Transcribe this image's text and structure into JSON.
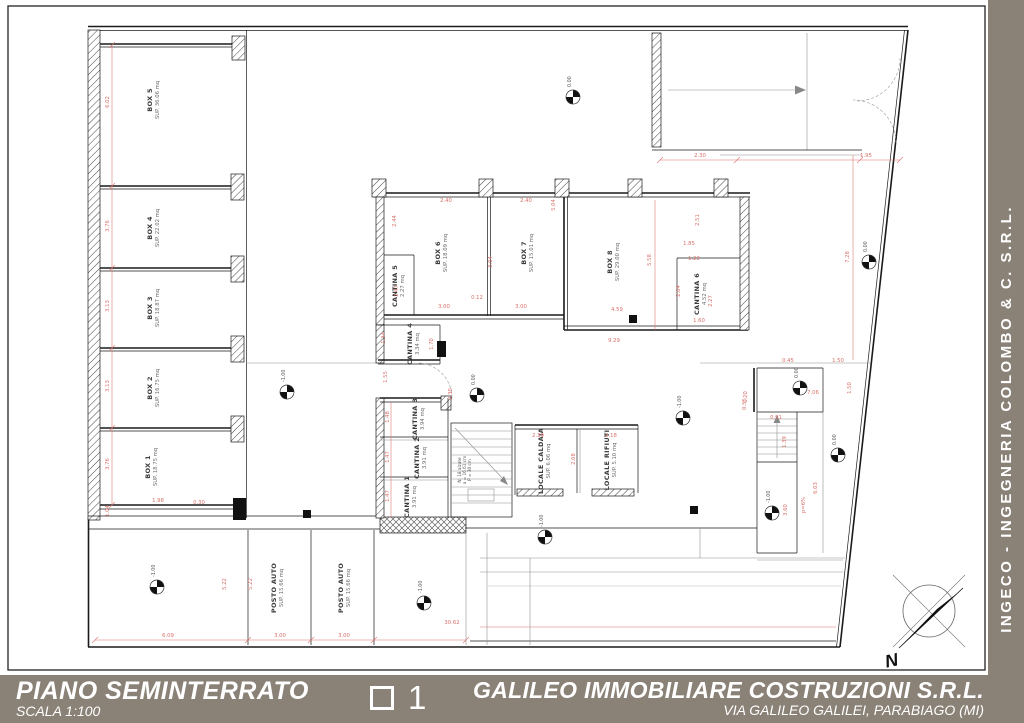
{
  "colors": {
    "band": "#8a8177",
    "dimred": "#d9706a",
    "wall": "#1a1a1a"
  },
  "titlebar": {
    "plan_title": "PIANO SEMINTERRATO",
    "scale": "SCALA 1:100",
    "sheet_number": "1",
    "company": "GALILEO IMMOBILIARE COSTRUZIONI S.R.L.",
    "address": "VIA GALILEO GALILEI, PARABIAGO (MI)"
  },
  "sidebar": {
    "text": "INGECO - INGEGNERIA COLOMBO & C. S.R.L."
  },
  "compass": {
    "label": "N"
  },
  "plan": {
    "rooms": [
      {
        "label": "BOX 5",
        "area": "SUP. 36.06 mq",
        "x": 152,
        "y": 100
      },
      {
        "label": "BOX 4",
        "area": "SUP. 22.02 mq",
        "x": 152,
        "y": 228
      },
      {
        "label": "BOX 3",
        "area": "SUP. 18.87 mq",
        "x": 152,
        "y": 308
      },
      {
        "label": "BOX 2",
        "area": "SUP. 16.75 mq",
        "x": 152,
        "y": 388
      },
      {
        "label": "BOX 1",
        "area": "SUP. 18.75 mq",
        "x": 150,
        "y": 467
      },
      {
        "label": "BOX 6",
        "area": "SUP. 18.09 mq",
        "x": 440,
        "y": 253
      },
      {
        "label": "BOX 7",
        "area": "SUP. 15.01 mq",
        "x": 526,
        "y": 253
      },
      {
        "label": "BOX 8",
        "area": "SUP. 29.00 mq",
        "x": 612,
        "y": 262
      },
      {
        "label": "CANTINA 5",
        "area": "2.27 mq",
        "x": 397,
        "y": 286
      },
      {
        "label": "CANTINA 4",
        "area": "3.34 mq",
        "x": 412,
        "y": 344
      },
      {
        "label": "CANTINA 3",
        "area": "3.94 mq",
        "x": 417,
        "y": 419
      },
      {
        "label": "CANTINA 2",
        "area": "3.91 mq",
        "x": 419,
        "y": 458
      },
      {
        "label": "CANTINA 1",
        "area": "3.91 mq",
        "x": 409,
        "y": 497
      },
      {
        "label": "CANTINA 6",
        "area": "4.52 mq",
        "x": 699,
        "y": 294
      },
      {
        "label": "LOCALE CALDAIA",
        "area": "SUP. 6.06 mq",
        "x": 543,
        "y": 461
      },
      {
        "label": "LOCALE RIFIUTI",
        "area": "SUP. 5.10 mq",
        "x": 609,
        "y": 460
      },
      {
        "label": "POSTO AUTO",
        "area": "SUP. 15.66 mq",
        "x": 276,
        "y": 588
      },
      {
        "label": "POSTO AUTO",
        "area": "SUP. 15.66 mq",
        "x": 343,
        "y": 588
      }
    ],
    "stair_note": {
      "lines": [
        "N. 18 alzate",
        "a = 16.61 cm",
        "P = 30 cm"
      ],
      "x": 461,
      "y": 470
    },
    "dimensions": [
      {
        "t": "6.02",
        "x": 109,
        "y": 102,
        "o": "v"
      },
      {
        "t": "3.76",
        "x": 109,
        "y": 226,
        "o": "v"
      },
      {
        "t": "3.13",
        "x": 109,
        "y": 306,
        "o": "v"
      },
      {
        "t": "3.13",
        "x": 109,
        "y": 386,
        "o": "v"
      },
      {
        "t": "3.76",
        "x": 109,
        "y": 464,
        "o": "v"
      },
      {
        "t": "1.04",
        "x": 109,
        "y": 511,
        "o": "v"
      },
      {
        "t": "1.98",
        "x": 158,
        "y": 502,
        "o": "h"
      },
      {
        "t": "0.30",
        "x": 199,
        "y": 504,
        "o": "h"
      },
      {
        "t": "5.22",
        "x": 226,
        "y": 584,
        "o": "v"
      },
      {
        "t": "5.22",
        "x": 252,
        "y": 584,
        "o": "v"
      },
      {
        "t": "3.00",
        "x": 280,
        "y": 637,
        "o": "h"
      },
      {
        "t": "3.00",
        "x": 344,
        "y": 637,
        "o": "h"
      },
      {
        "t": "6.09",
        "x": 168,
        "y": 637,
        "o": "h"
      },
      {
        "t": "30.62",
        "x": 452,
        "y": 624,
        "o": "h"
      },
      {
        "t": "2.44",
        "x": 396,
        "y": 221,
        "o": "v"
      },
      {
        "t": "2.47",
        "x": 398,
        "y": 291,
        "o": "v"
      },
      {
        "t": "2.40",
        "x": 446,
        "y": 202,
        "o": "h"
      },
      {
        "t": "2.40",
        "x": 526,
        "y": 202,
        "o": "h"
      },
      {
        "t": "3.04",
        "x": 492,
        "y": 262,
        "o": "v"
      },
      {
        "t": "5.04",
        "x": 555,
        "y": 205,
        "o": "v"
      },
      {
        "t": "0.12",
        "x": 477,
        "y": 299,
        "o": "h"
      },
      {
        "t": "3.00",
        "x": 444,
        "y": 308,
        "o": "h"
      },
      {
        "t": "3.00",
        "x": 521,
        "y": 308,
        "o": "h"
      },
      {
        "t": "5.58",
        "x": 651,
        "y": 260,
        "o": "v"
      },
      {
        "t": "2.51",
        "x": 699,
        "y": 220,
        "o": "v"
      },
      {
        "t": "1.85",
        "x": 689,
        "y": 245,
        "o": "h"
      },
      {
        "t": "1.22",
        "x": 694,
        "y": 260,
        "o": "h"
      },
      {
        "t": "2.04",
        "x": 680,
        "y": 291,
        "o": "v"
      },
      {
        "t": "2.27",
        "x": 712,
        "y": 301,
        "o": "v"
      },
      {
        "t": "1.60",
        "x": 699,
        "y": 322,
        "o": "h"
      },
      {
        "t": "4.59",
        "x": 617,
        "y": 311,
        "o": "h"
      },
      {
        "t": "9.29",
        "x": 614,
        "y": 342,
        "o": "h"
      },
      {
        "t": "1.34",
        "x": 385,
        "y": 338,
        "o": "v"
      },
      {
        "t": "1.70",
        "x": 433,
        "y": 344,
        "o": "v"
      },
      {
        "t": "1.55",
        "x": 387,
        "y": 377,
        "o": "v"
      },
      {
        "t": "2.30",
        "x": 452,
        "y": 394,
        "o": "v"
      },
      {
        "t": "1.48",
        "x": 389,
        "y": 417,
        "o": "v"
      },
      {
        "t": "1.47",
        "x": 389,
        "y": 457,
        "o": "v"
      },
      {
        "t": "1.47",
        "x": 389,
        "y": 496,
        "o": "v"
      },
      {
        "t": "2.39",
        "x": 538,
        "y": 437,
        "o": "h"
      },
      {
        "t": "2.18",
        "x": 611,
        "y": 437,
        "o": "h"
      },
      {
        "t": "2.08",
        "x": 575,
        "y": 459,
        "o": "v"
      },
      {
        "t": "2.30",
        "x": 700,
        "y": 157,
        "o": "h"
      },
      {
        "t": "1.95",
        "x": 866,
        "y": 157,
        "o": "h"
      },
      {
        "t": "7.28",
        "x": 849,
        "y": 257,
        "o": "v"
      },
      {
        "t": "0.45",
        "x": 788,
        "y": 362,
        "o": "h"
      },
      {
        "t": "1.50",
        "x": 838,
        "y": 362,
        "o": "h"
      },
      {
        "t": "1.50",
        "x": 851,
        "y": 388,
        "o": "v"
      },
      {
        "t": "7.06",
        "x": 813,
        "y": 394,
        "o": "h"
      },
      {
        "t": "1.20",
        "x": 747,
        "y": 397,
        "o": "v"
      },
      {
        "t": "0.91",
        "x": 776,
        "y": 419,
        "o": "h"
      },
      {
        "t": "1.39",
        "x": 786,
        "y": 442,
        "o": "v"
      },
      {
        "t": "0.55",
        "x": 746,
        "y": 404,
        "o": "v"
      },
      {
        "t": "3.60",
        "x": 787,
        "y": 510,
        "o": "v"
      },
      {
        "t": "6.03",
        "x": 817,
        "y": 488,
        "o": "v"
      },
      {
        "t": "p=6%",
        "x": 805,
        "y": 505,
        "o": "v"
      }
    ],
    "levels": [
      {
        "t": "-1.00",
        "x": 157,
        "y": 587
      },
      {
        "t": "-1.00",
        "x": 287,
        "y": 392
      },
      {
        "t": "-1.00",
        "x": 424,
        "y": 603
      },
      {
        "t": "0.00",
        "x": 477,
        "y": 395
      },
      {
        "t": "-1.00",
        "x": 545,
        "y": 537
      },
      {
        "t": "0.00",
        "x": 573,
        "y": 97
      },
      {
        "t": "-1.00",
        "x": 683,
        "y": 418
      },
      {
        "t": "-1.00",
        "x": 772,
        "y": 513
      },
      {
        "t": "0.00",
        "x": 800,
        "y": 388
      },
      {
        "t": "0.00",
        "x": 838,
        "y": 455
      },
      {
        "t": "0.00",
        "x": 869,
        "y": 262
      }
    ],
    "columns": [
      {
        "x": 307,
        "y": 514
      },
      {
        "x": 633,
        "y": 319
      },
      {
        "x": 694,
        "y": 510
      }
    ]
  }
}
